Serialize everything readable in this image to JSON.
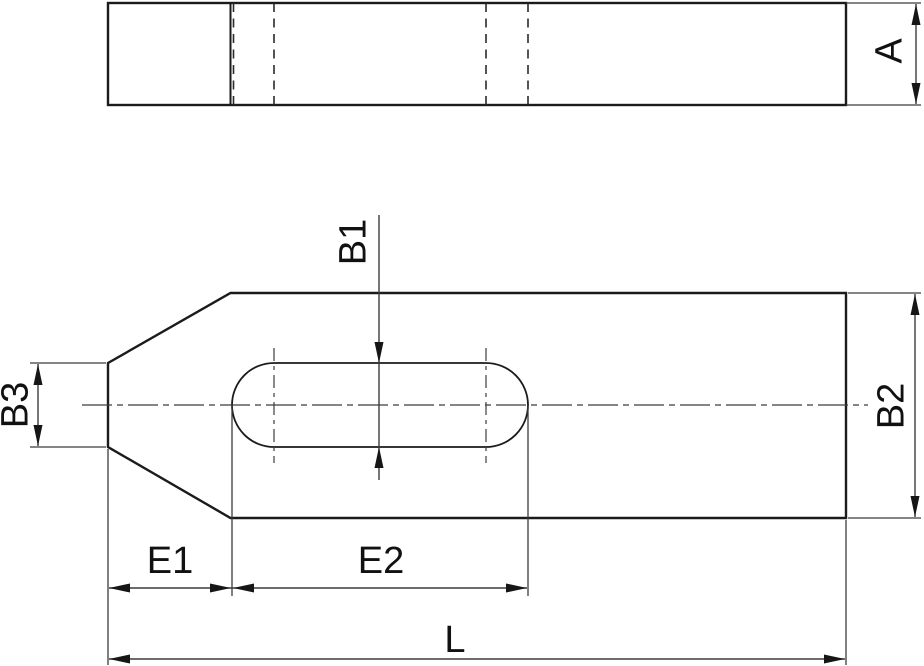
{
  "drawing": {
    "kind": "technical-drawing-clamping-plate",
    "views": [
      "side-elevation",
      "plan-view"
    ]
  },
  "labels": {
    "A": "A",
    "B1": "B1",
    "B2": "B2",
    "B3": "B3",
    "E1": "E1",
    "E2": "E2",
    "L": "L"
  },
  "colors": {
    "background": "#ffffff",
    "outline": "#1b1b1b",
    "hidden_line": "#2a2a2a",
    "dimension_line": "#3c3c3c",
    "text": "#111111"
  }
}
